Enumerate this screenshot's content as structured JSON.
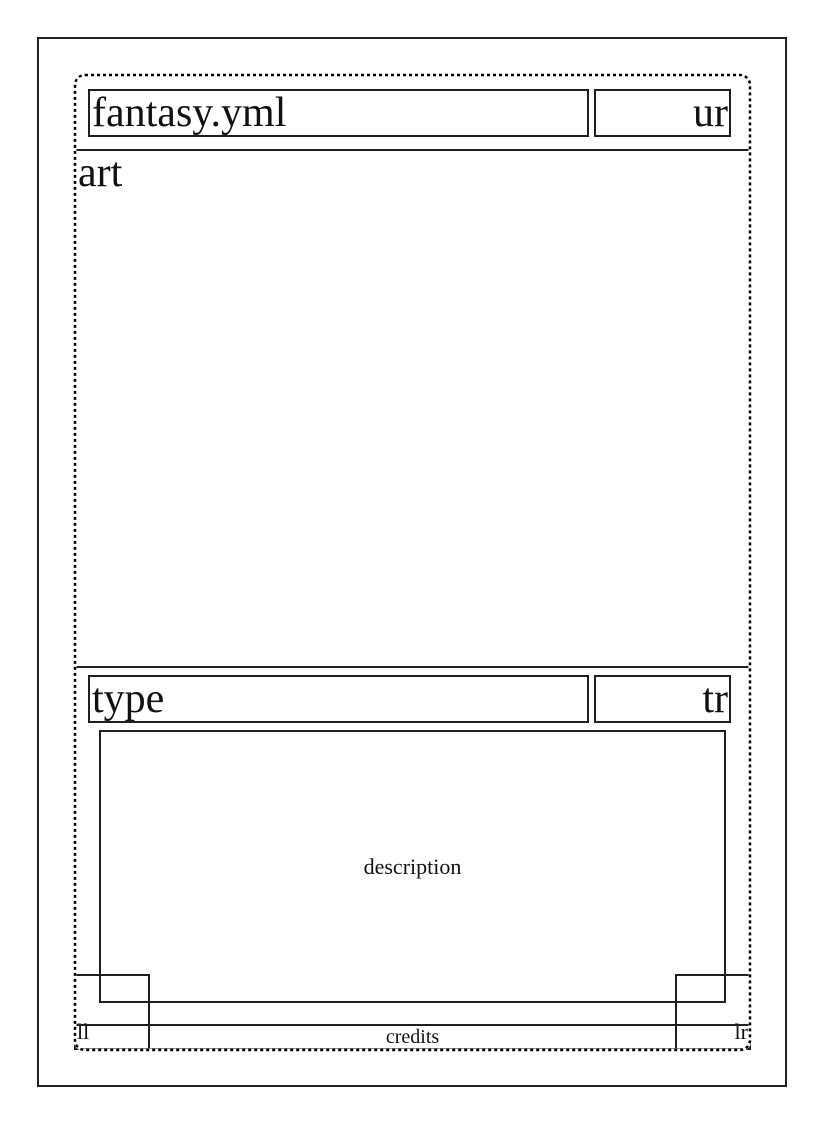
{
  "card_template": {
    "title": "fantasy.yml",
    "upper_right": "ur",
    "art": "art",
    "type": "type",
    "type_right": "tr",
    "description": "description",
    "lower_left": "ll",
    "lower_right": "lr",
    "credits": "credits"
  },
  "colors": {
    "ink": "#1f1f1f",
    "paper": "#ffffff"
  }
}
